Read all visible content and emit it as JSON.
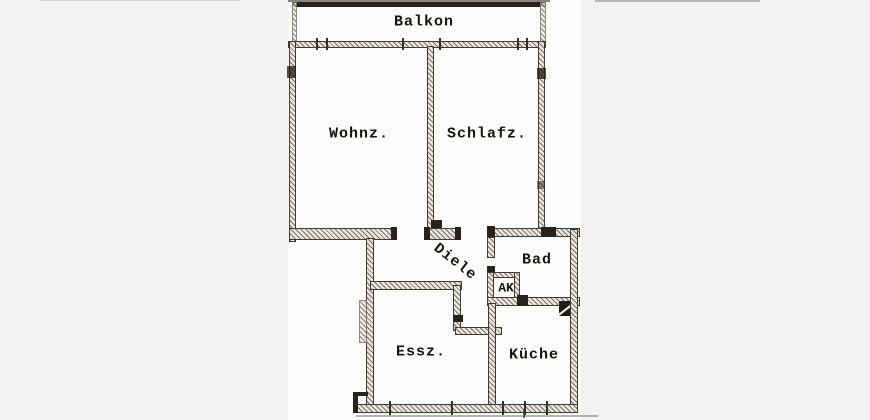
{
  "document": {
    "type": "scanned-floor-plan",
    "language": "de"
  },
  "rooms": {
    "balkon": {
      "label": "Balkon"
    },
    "wohnz": {
      "label": "Wohnz."
    },
    "schlafz": {
      "label": "Schlafz."
    },
    "diele": {
      "label": "Diele"
    },
    "bad": {
      "label": "Bad"
    },
    "ak": {
      "label": "AK"
    },
    "essz": {
      "label": "Essz."
    },
    "kueche": {
      "label": "Küche"
    }
  },
  "colors": {
    "wall_dark": "#26231e",
    "wall_hatch": "#76726a",
    "paper": "#fdfdfb",
    "background": "#f2f2f0",
    "text": "#17140f"
  }
}
